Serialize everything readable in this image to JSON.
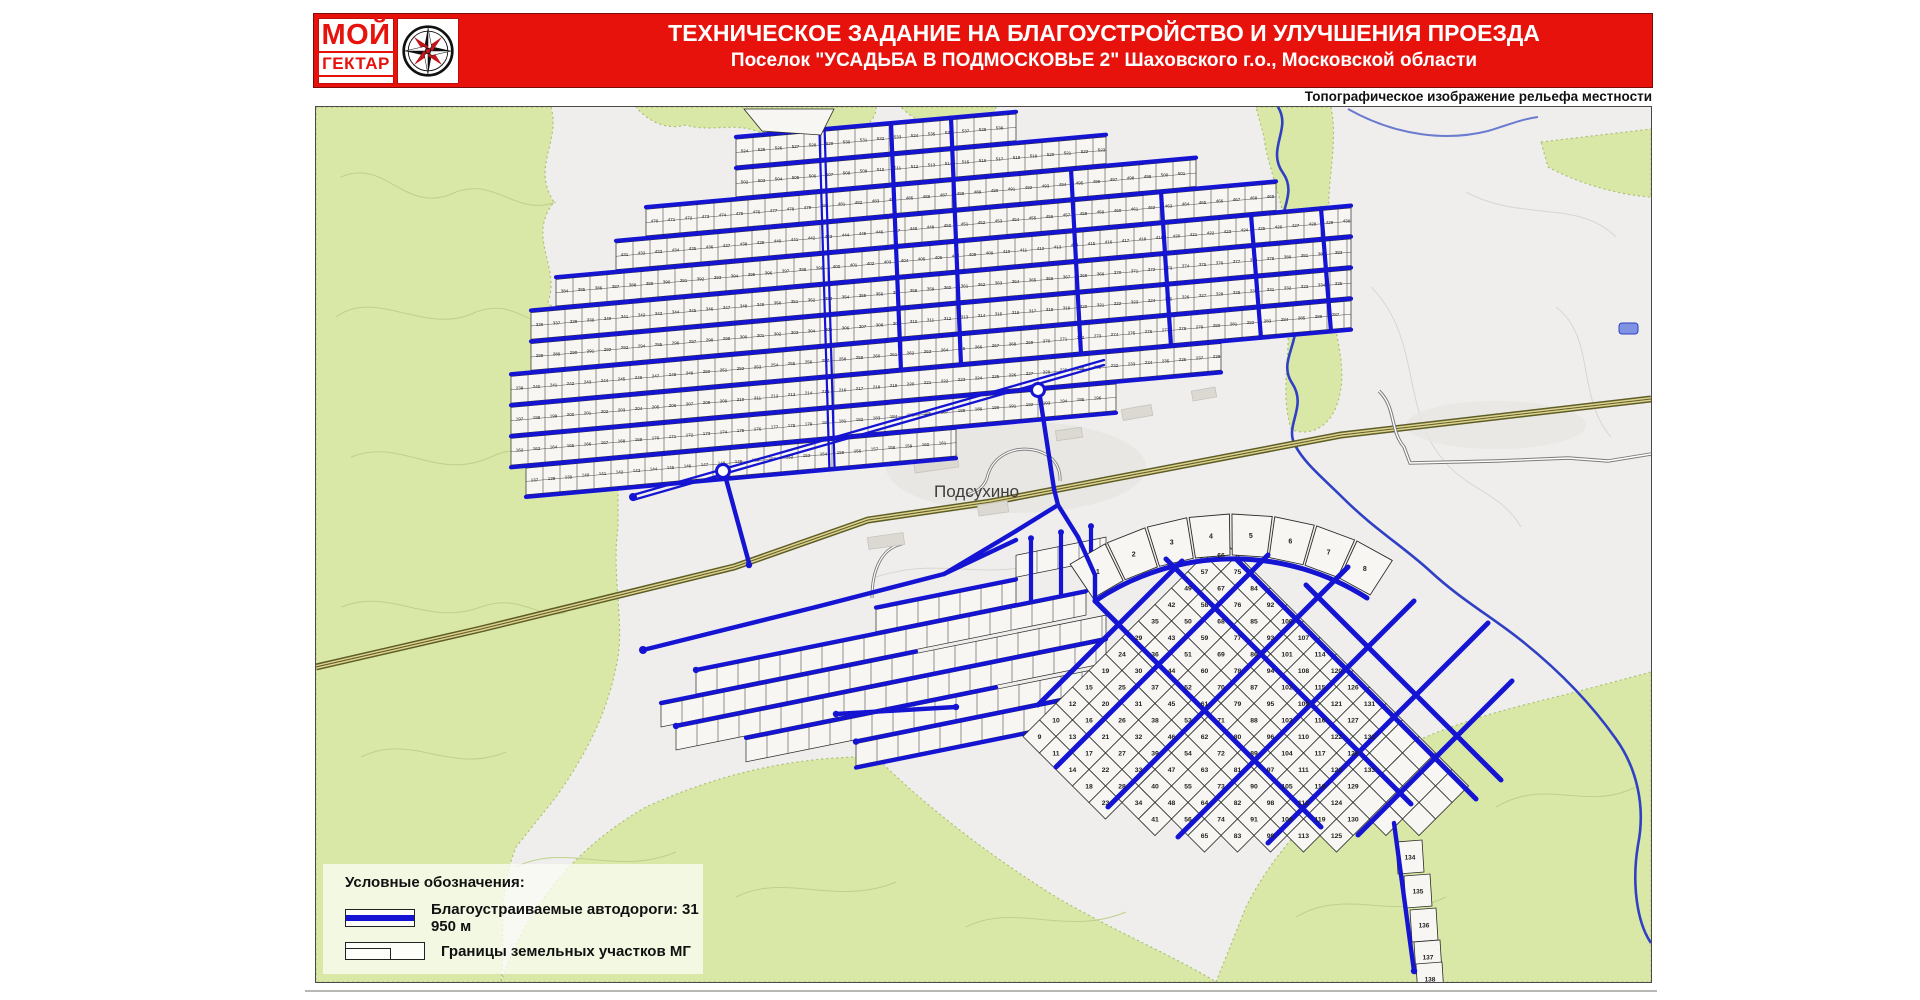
{
  "header": {
    "logo": {
      "line1": "МОЙ",
      "line2": "ГЕКТАР",
      "icon": "compass-rose-icon"
    },
    "title": "ТЕХНИЧЕСКОЕ ЗАДАНИЕ НА БЛАГОУСТРОЙСТВО И УЛУЧШЕНИЯ ПРОЕЗДА",
    "subtitle": "Поселок \"УСАДЬБА В ПОДМОСКОВЬЕ 2\" Шаховского г.о., Московской области",
    "map_note": "Топографическое изображение рельефа местности"
  },
  "map": {
    "village_label": "Подсухино",
    "legend": {
      "title": "Условные обозначения:",
      "items": [
        {
          "symbol": "improved-road",
          "label": "Благоустраиваемые автодороги: 31 950 м"
        },
        {
          "symbol": "plot-boundaries",
          "label": "Границы земельных участков МГ"
        }
      ]
    },
    "grids": {
      "north": {
        "plot_numbers_from": 137,
        "plot_numbers_to": 620
      },
      "southeast": {
        "plot_numbers_from": 1,
        "plot_numbers_to": 138
      }
    },
    "colors": {
      "banner_red": "#e8120c",
      "road_blue": "#1414d2",
      "forest_green": "#d9e8a6",
      "forest_edge": "#a9bf77",
      "plot_fill": "#f7f6f3",
      "plot_stroke": "#2a2a2a",
      "highway_olive": "#5d5d28",
      "highway_fill": "#ded28e",
      "river_blue": "#3040c5",
      "map_bg": "#efeeec",
      "label_gray": "#3c3c3c"
    }
  }
}
